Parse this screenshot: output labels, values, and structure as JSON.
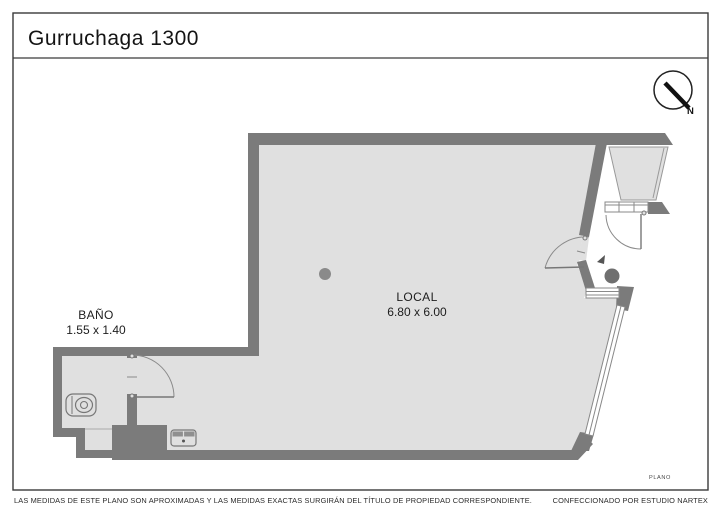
{
  "header": {
    "title": "Gurruchaga 1300"
  },
  "compass": {
    "label": "N"
  },
  "plan": {
    "sheet_label": "PLANO",
    "rooms": [
      {
        "name": "BAÑO",
        "dimensions": "1.55 x 1.40"
      },
      {
        "name": "LOCAL",
        "dimensions": "6.80 x 6.00"
      }
    ]
  },
  "footer": {
    "disclaimer": "LAS MEDIDAS DE ESTE PLANO SON APROXIMADAS Y LAS MEDIDAS EXACTAS SURGIRÁN DEL TÍTULO DE PROPIEDAD CORRESPONDIENTE.",
    "credit": "CONFECCIONADO POR ESTUDIO NARTEX"
  },
  "colors": {
    "wall": "#7b7b7b",
    "floor": "#e0e0e0",
    "frame": "#3a3a3a"
  }
}
